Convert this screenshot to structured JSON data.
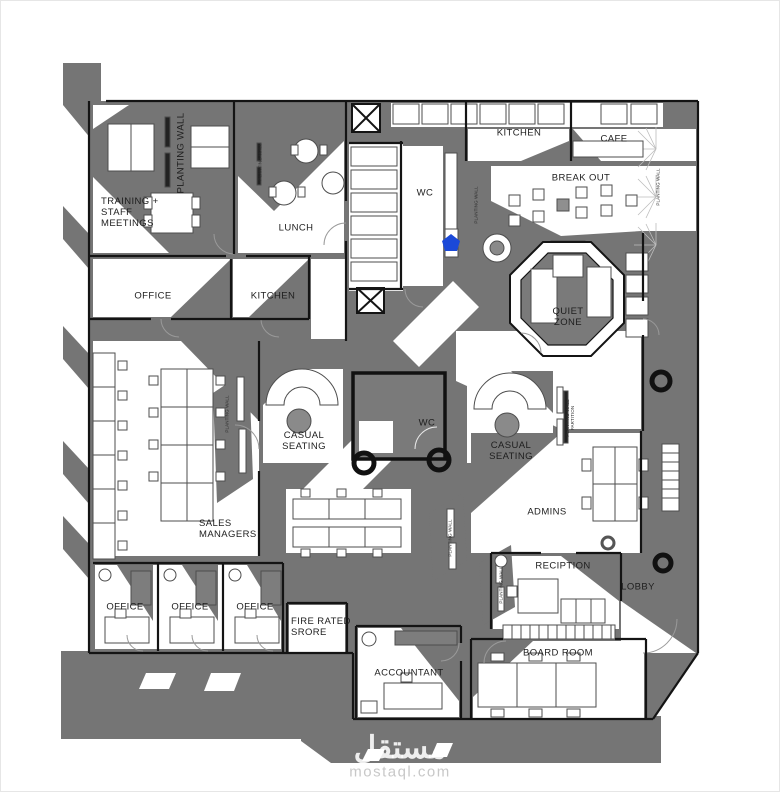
{
  "document": {
    "type": "architectural office floor plan"
  },
  "colors": {
    "shadow_gray": "#757575",
    "light_gray": "#8a8a8a",
    "wall_black": "#141414",
    "accent_blue": "#1b49d8",
    "watermark_gray": "#c8c8c8"
  },
  "labels": {
    "training": {
      "text": "TRAINING +\nSTAFF\nMEETINGS"
    },
    "lunch": {
      "text": "LUNCH"
    },
    "office_top": {
      "text": "OFFICE"
    },
    "kitchen_left": {
      "text": "KITCHEN"
    },
    "wc_top": {
      "text": "WC"
    },
    "kitchen_top": {
      "text": "KITCHEN"
    },
    "cafe": {
      "text": "CAFE"
    },
    "break_out": {
      "text": "BREAK OUT"
    },
    "quiet_zone": {
      "text": "QUIET\nZONE"
    },
    "casual_seating_left": {
      "text": "CASUAL\nSEATING"
    },
    "wc_pod": {
      "text": "WC"
    },
    "casual_seating_right": {
      "text": "CASUAL\nSEATING"
    },
    "sales_managers": {
      "text": "SALES\nMANAGERS"
    },
    "admins": {
      "text": "ADMINS"
    },
    "reception": {
      "text": "RECIPTION"
    },
    "lobby": {
      "text": "LOBBY"
    },
    "office_bottom_1": {
      "text": "OFFICE"
    },
    "office_bottom_2": {
      "text": "OFFICE"
    },
    "office_bottom_3": {
      "text": "OFFICE"
    },
    "fire_rated_store": {
      "text": "FIRE RATED\nSRORE"
    },
    "accountant": {
      "text": "ACCOUNTANT"
    },
    "board_room": {
      "text": "BOARD ROOM"
    }
  },
  "planting_walls": {
    "main": {
      "text": "PLANTING WALL"
    },
    "lunch_side": {
      "text": "PLANTING WALL"
    },
    "corridor": {
      "text": "PLANTING WALL"
    },
    "cafe_wall": {
      "text": "PLANTING WALL"
    },
    "sales_side": {
      "text": "PLANTING WALL"
    },
    "admins_a": {
      "text": "PLANTING WALL"
    },
    "admins_b": {
      "text": "PLANTING WALL"
    },
    "partition": {
      "text": "PLANTING WALL\nPARTITION"
    }
  },
  "watermark": {
    "logo_text": "مستقل",
    "site_text": "mostaql.com"
  }
}
